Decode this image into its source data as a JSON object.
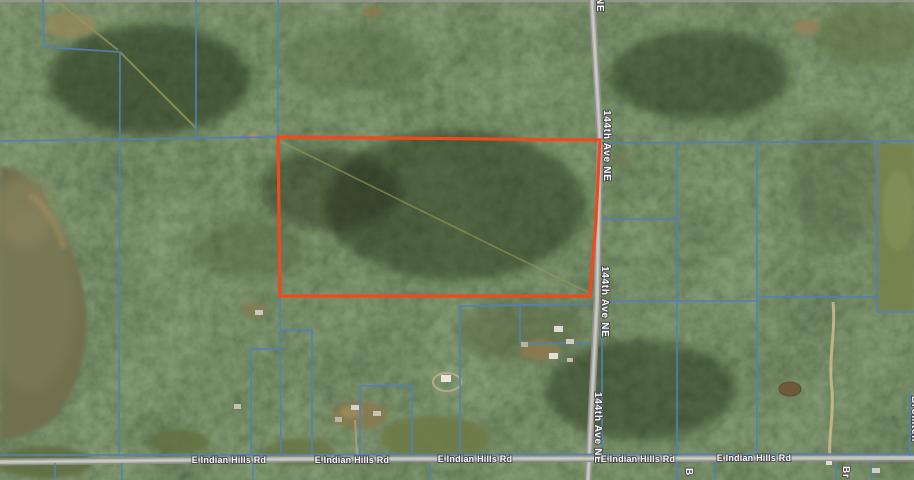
{
  "map": {
    "kind": "satellite-parcel-map",
    "parcel": {
      "outline_color": "#ee4a1e"
    },
    "colors": {
      "boundary": "#5381b8",
      "road_fill": "#a2a29d",
      "road_center": "#c6c6c0",
      "label_text": "#ffffff"
    },
    "roads": {
      "ave_144": {
        "name": "144th Ave NE",
        "fragment_top": "NE"
      },
      "indian_hills": {
        "name": "E Indian Hills Rd"
      },
      "edge_fragments": {
        "bottom_center": "B",
        "bottom_right": "Br",
        "right_edge": "Bromten"
      }
    }
  }
}
